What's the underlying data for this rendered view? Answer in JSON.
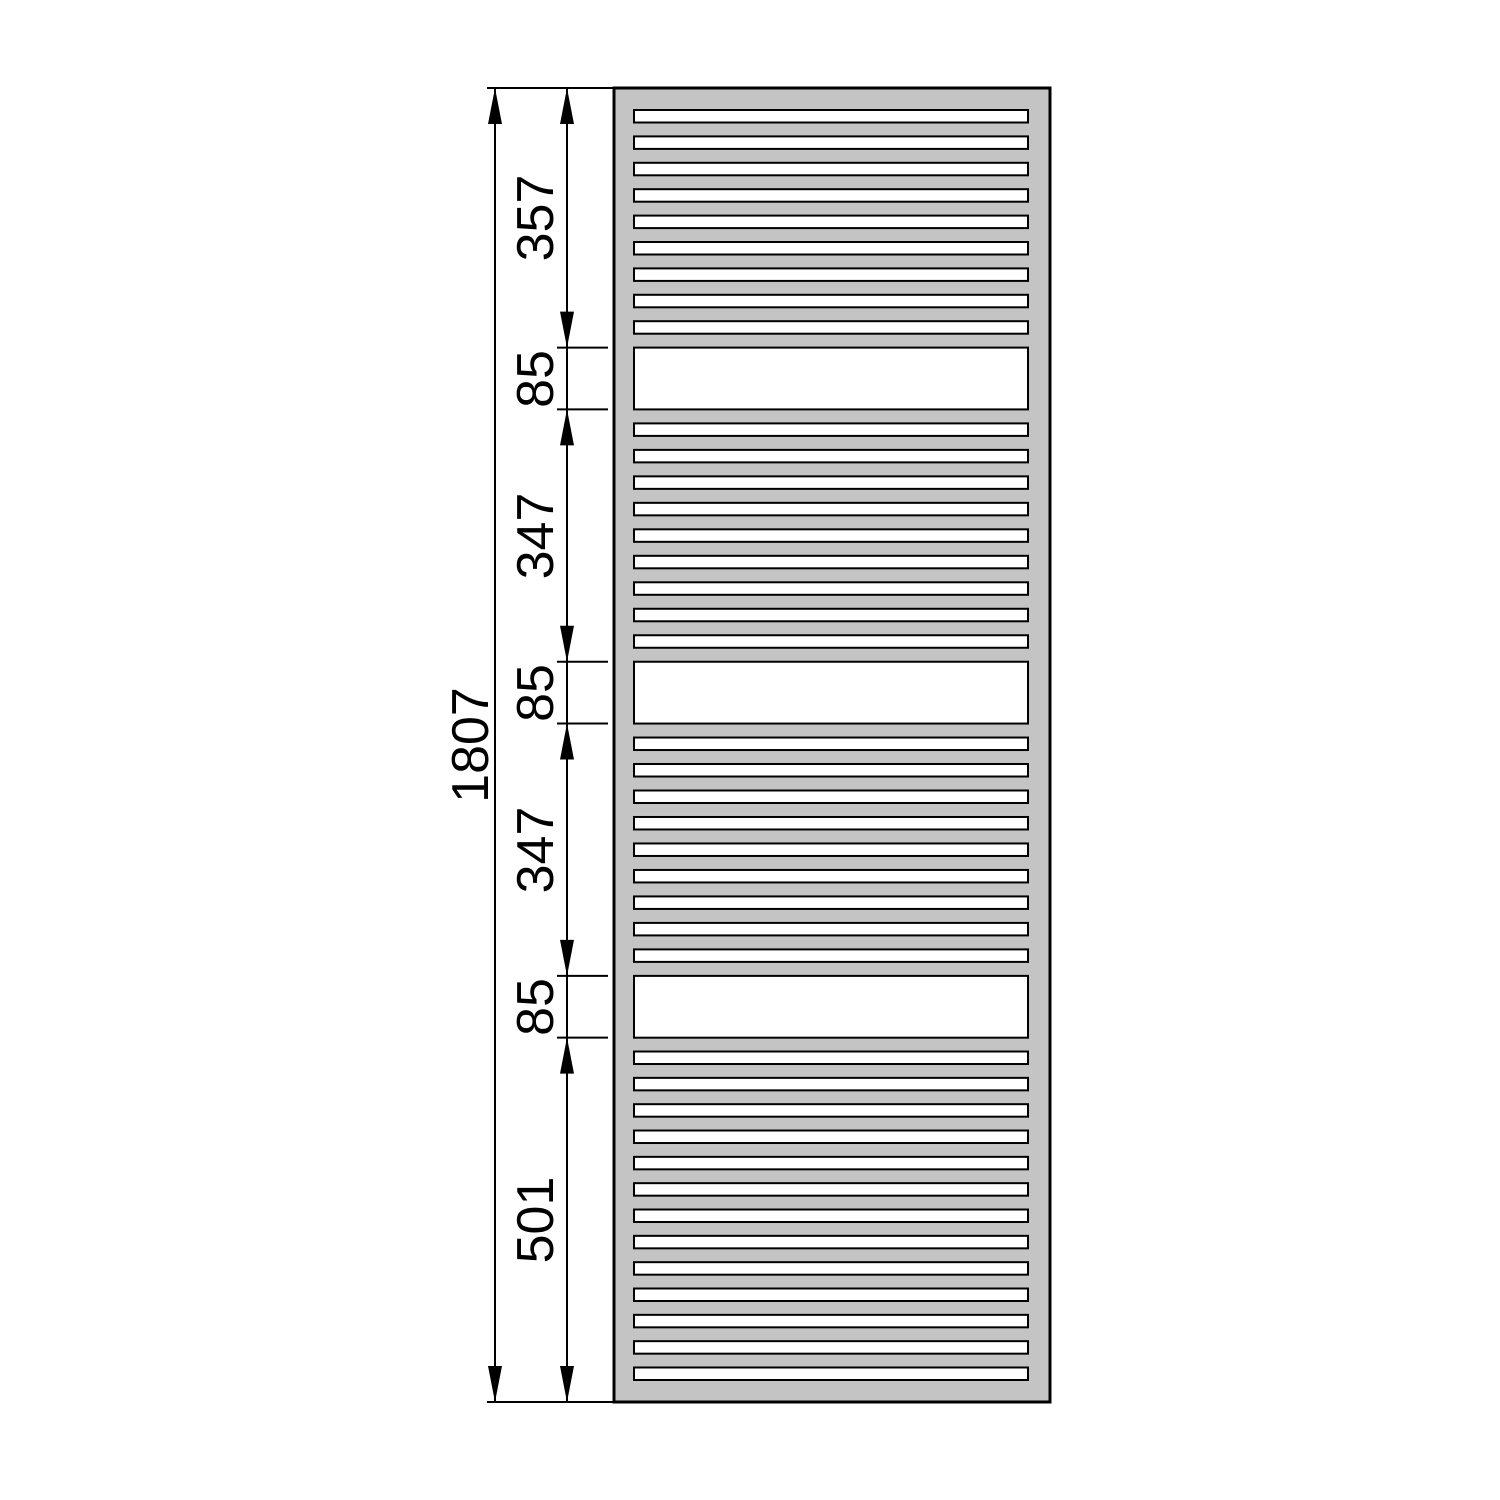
{
  "figure": {
    "type": "technical-drawing",
    "subject": "towel-radiator-front-elevation-with-vertical-dimensions",
    "units": "mm",
    "colors": {
      "radiator_fill": "#c4c4c4",
      "line": "#000000",
      "background": "#ffffff"
    },
    "total_height": {
      "label": "1807",
      "value": 1807
    },
    "segments": [
      {
        "label": "357",
        "value": 357,
        "pattern": "tube-group-top-frame",
        "gap_count": 9
      },
      {
        "label": "85",
        "value": 85,
        "pattern": "open-gap"
      },
      {
        "label": "347",
        "value": 347,
        "pattern": "tube-group",
        "gap_count": 9
      },
      {
        "label": "85",
        "value": 85,
        "pattern": "open-gap"
      },
      {
        "label": "347",
        "value": 347,
        "pattern": "tube-group",
        "gap_count": 9
      },
      {
        "label": "85",
        "value": 85,
        "pattern": "open-gap"
      },
      {
        "label": "501",
        "value": 501,
        "pattern": "tube-group-bottom-frame",
        "gap_count": 13
      }
    ]
  }
}
